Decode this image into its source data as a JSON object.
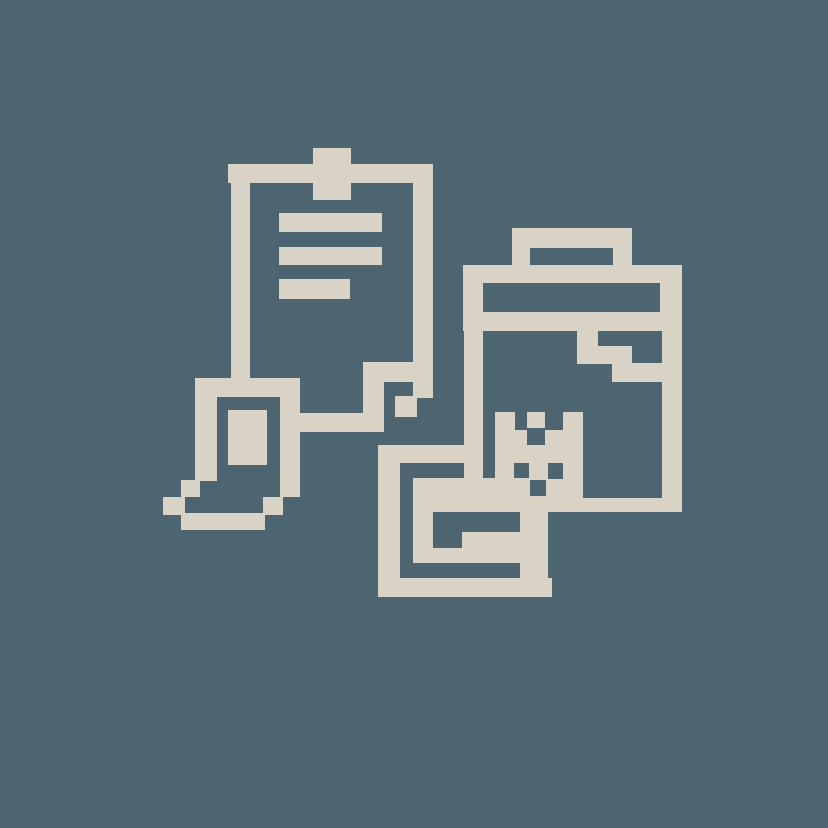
{
  "canvas": {
    "width": 828,
    "height": 828,
    "background_color": "#4d6570"
  },
  "icon": {
    "name": "pixelated-clipboards-icon",
    "description": "pixel-art icon of two clipboards with document fragments",
    "foreground_color": "#d8d3c5",
    "shapes": [
      {
        "name": "clipboard-front",
        "parts": [
          {
            "part": "tab",
            "rect": [
              313,
              148,
              38,
              52
            ]
          },
          {
            "part": "top-bar",
            "rect": [
              228,
              164,
              205,
              19
            ]
          },
          {
            "part": "left-bar",
            "rect": [
              231,
              164,
              19,
              219
            ]
          },
          {
            "part": "right-bar",
            "rect": [
              413,
              164,
              20,
              234
            ]
          },
          {
            "part": "text-line-1",
            "rect": [
              279,
              213,
              103,
              19
            ]
          },
          {
            "part": "text-line-2",
            "rect": [
              279,
              247,
              103,
              18
            ]
          },
          {
            "part": "text-line-3",
            "rect": [
              279,
              279,
              71,
              20
            ]
          },
          {
            "part": "bottom-bar",
            "rect": [
              297,
              413,
              87,
              19
            ]
          },
          {
            "part": "fold-step-v",
            "rect": [
              363,
              362,
              21,
              70
            ]
          },
          {
            "part": "fold-step-h",
            "rect": [
              363,
              362,
              50,
              20
            ]
          },
          {
            "part": "fold-corner",
            "rect": [
              395,
              396,
              22,
              21
            ]
          }
        ]
      },
      {
        "name": "small-document",
        "parts": [
          {
            "part": "top-bar",
            "rect": [
              195,
              378,
              105,
              19
            ]
          },
          {
            "part": "left-bar",
            "rect": [
              195,
              378,
              22,
              103
            ]
          },
          {
            "part": "right-bar",
            "rect": [
              280,
              397,
              20,
              100
            ]
          },
          {
            "part": "inner-block",
            "rect": [
              228,
              410,
              39,
              55
            ]
          },
          {
            "part": "step-square-1",
            "rect": [
              181,
              480,
              19,
              17
            ]
          },
          {
            "part": "step-square-2",
            "rect": [
              163,
              497,
              22,
              18
            ]
          },
          {
            "part": "bottom-bar",
            "rect": [
              181,
              513,
              84,
              17
            ]
          },
          {
            "part": "step-square-3",
            "rect": [
              263,
              497,
              20,
              18
            ]
          }
        ]
      },
      {
        "name": "clipboard-back",
        "parts": [
          {
            "part": "handle-top",
            "rect": [
              512,
              228,
              120,
              20
            ]
          },
          {
            "part": "handle-left",
            "rect": [
              512,
              228,
              18,
              38
            ]
          },
          {
            "part": "handle-right",
            "rect": [
              613,
              228,
              19,
              38
            ]
          },
          {
            "part": "header-top",
            "rect": [
              463,
              265,
              219,
              18
            ]
          },
          {
            "part": "header-left",
            "rect": [
              463,
              283,
              20,
              29
            ]
          },
          {
            "part": "header-right",
            "rect": [
              660,
              283,
              22,
              29
            ]
          },
          {
            "part": "header-bottom",
            "rect": [
              463,
              312,
              219,
              19
            ]
          },
          {
            "part": "left-bar",
            "rect": [
              464,
              331,
              19,
              147
            ]
          },
          {
            "part": "right-bar",
            "rect": [
              662,
              331,
              20,
              181
            ]
          },
          {
            "part": "notch-column",
            "rect": [
              577,
              331,
              21,
              33
            ]
          },
          {
            "part": "notch-step",
            "rect": [
              597,
              346,
              35,
              18
            ]
          },
          {
            "part": "notch-bar",
            "rect": [
              612,
              363,
              70,
              19
            ]
          },
          {
            "part": "bottom-bar",
            "rect": [
              462,
              498,
              200,
              14
            ]
          }
        ]
      },
      {
        "name": "castle-fragment",
        "parts": [
          {
            "part": "left-tower",
            "rect": [
              495,
              412,
              20,
              33
            ]
          },
          {
            "part": "right-tower",
            "rect": [
              563,
              412,
              20,
              33
            ]
          },
          {
            "part": "mid-top-block",
            "rect": [
              527,
              412,
              18,
              16
            ]
          },
          {
            "part": "mid-left-block",
            "rect": [
              515,
              430,
              12,
              15
            ]
          },
          {
            "part": "mid-right-block",
            "rect": [
              545,
              430,
              18,
              15
            ]
          },
          {
            "part": "base-row-1",
            "rect": [
              495,
              445,
              88,
              18
            ]
          },
          {
            "part": "base-row-2-left",
            "rect": [
              495,
              463,
              19,
              16
            ]
          },
          {
            "part": "base-row-2-mid",
            "rect": [
              529,
              463,
              19,
              16
            ]
          },
          {
            "part": "base-row-2-right",
            "rect": [
              563,
              463,
              20,
              16
            ]
          },
          {
            "part": "base-row-3",
            "rect": [
              495,
              479,
              88,
              19
            ]
          }
        ]
      },
      {
        "name": "spiral-fragment",
        "parts": [
          {
            "part": "outer-left-bar",
            "rect": [
              378,
              445,
              22,
              152
            ]
          },
          {
            "part": "outer-top-bar",
            "rect": [
              378,
              445,
              102,
              18
            ]
          },
          {
            "part": "outer-bottom-bar",
            "rect": [
              378,
              578,
              174,
              19
            ]
          },
          {
            "part": "mid-block",
            "rect": [
              413,
              478,
              135,
              34
            ]
          },
          {
            "part": "ring-left-bar",
            "rect": [
              413,
              478,
              20,
              85
            ]
          },
          {
            "part": "inner-block",
            "rect": [
              462,
              532,
              58,
              31
            ]
          },
          {
            "part": "inner-arm",
            "rect": [
              433,
              548,
              29,
              15
            ]
          },
          {
            "part": "right-bar",
            "rect": [
              520,
              478,
              28,
              119
            ]
          }
        ]
      }
    ],
    "cutouts": [
      {
        "part": "castle-center-hole",
        "rect": [
          530,
          480,
          16,
          16
        ]
      }
    ]
  }
}
